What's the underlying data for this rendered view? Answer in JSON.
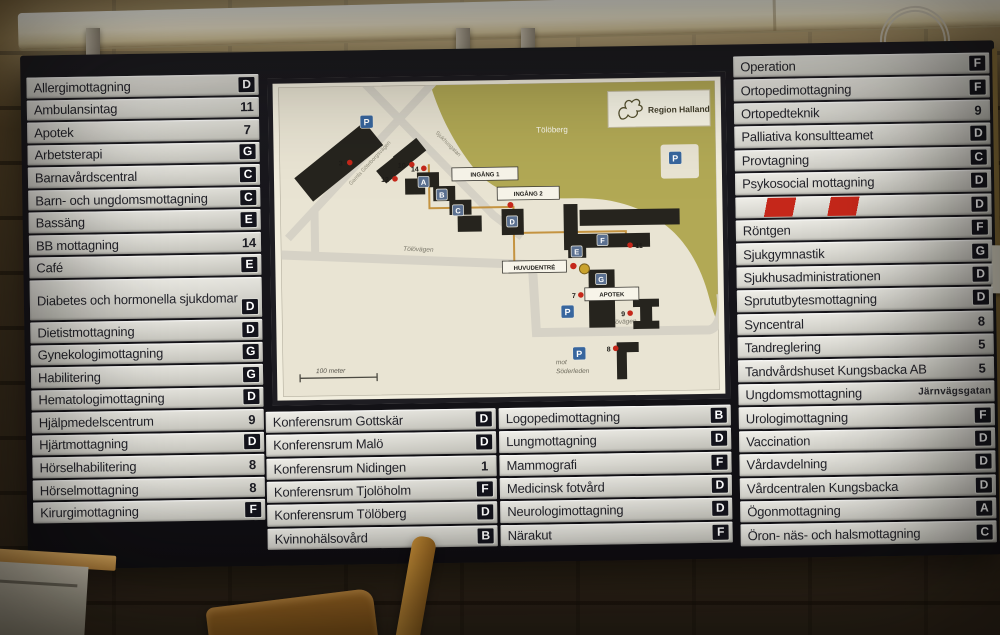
{
  "panels": {
    "left": {
      "rows": [
        {
          "label": "Allergimottagning",
          "value": "D",
          "kind": "letter"
        },
        {
          "label": "Ambulansintag",
          "value": "11",
          "kind": "number"
        },
        {
          "label": "Apotek",
          "value": "7",
          "kind": "number"
        },
        {
          "label": "Arbetsterapi",
          "value": "G",
          "kind": "letter"
        },
        {
          "label": "Barnavårdscentral",
          "value": "C",
          "kind": "letter"
        },
        {
          "label": "Barn- och ungdomsmottagning",
          "value": "C",
          "kind": "letter"
        },
        {
          "label": "Bassäng",
          "value": "E",
          "kind": "letter"
        },
        {
          "label": "BB mottagning",
          "value": "14",
          "kind": "number"
        },
        {
          "label": "Café",
          "value": "E",
          "kind": "letter"
        },
        {
          "label": "Diabetes och hormonella sjukdomar",
          "value": "D",
          "kind": "letter",
          "tall": true
        },
        {
          "label": "Dietistmottagning",
          "value": "D",
          "kind": "letter"
        },
        {
          "label": "Gynekologimottagning",
          "value": "G",
          "kind": "letter"
        },
        {
          "label": "Habilitering",
          "value": "G",
          "kind": "letter"
        },
        {
          "label": "Hematologimottagning",
          "value": "D",
          "kind": "letter"
        },
        {
          "label": "Hjälpmedelscentrum",
          "value": "9",
          "kind": "number"
        },
        {
          "label": "Hjärtmottagning",
          "value": "D",
          "kind": "letter"
        },
        {
          "label": "Hörselhabilitering",
          "value": "8",
          "kind": "number"
        },
        {
          "label": "Hörselmottagning",
          "value": "8",
          "kind": "number"
        },
        {
          "label": "Kirurgimottagning",
          "value": "F",
          "kind": "letter"
        }
      ]
    },
    "conference": {
      "rows": [
        {
          "label": "Konferensrum Gottskär",
          "value": "D",
          "kind": "letter"
        },
        {
          "label": "Konferensrum Malö",
          "value": "D",
          "kind": "letter"
        },
        {
          "label": "Konferensrum Nidingen",
          "value": "1",
          "kind": "number"
        },
        {
          "label": "Konferensrum Tjolöholm",
          "value": "F",
          "kind": "letter"
        },
        {
          "label": "Konferensrum Tölöberg",
          "value": "D",
          "kind": "letter"
        },
        {
          "label": "Kvinnohälsovård",
          "value": "B",
          "kind": "letter"
        }
      ]
    },
    "clinics": {
      "rows": [
        {
          "label": "Logopedimottagning",
          "value": "B",
          "kind": "letter"
        },
        {
          "label": "Lungmottagning",
          "value": "D",
          "kind": "letter"
        },
        {
          "label": "Mammografi",
          "value": "F",
          "kind": "letter"
        },
        {
          "label": "Medicinsk fotvård",
          "value": "D",
          "kind": "letter"
        },
        {
          "label": "Neurologimottagning",
          "value": "D",
          "kind": "letter"
        },
        {
          "label": "Närakut",
          "value": "F",
          "kind": "letter"
        }
      ]
    },
    "right": {
      "rows": [
        {
          "label": "Operation",
          "value": "F",
          "kind": "letter"
        },
        {
          "label": "Ortopedimottagning",
          "value": "F",
          "kind": "letter"
        },
        {
          "label": "Ortopedteknik",
          "value": "9",
          "kind": "number"
        },
        {
          "label": "Palliativa konsultteamet",
          "value": "D",
          "kind": "letter"
        },
        {
          "label": "Provtagning",
          "value": "C",
          "kind": "letter"
        },
        {
          "label": "Psykosocial mottagning",
          "value": "D",
          "kind": "letter"
        },
        {
          "label": "",
          "value": "D",
          "kind": "striped"
        },
        {
          "label": "Röntgen",
          "value": "F",
          "kind": "letter"
        },
        {
          "label": "Sjukgymnastik",
          "value": "G",
          "kind": "letter"
        },
        {
          "label": "Sjukhusadministrationen",
          "value": "D",
          "kind": "letter"
        },
        {
          "label": "Sprututbytesmottagning",
          "value": "D",
          "kind": "letter"
        },
        {
          "label": "Syncentral",
          "value": "8",
          "kind": "number"
        },
        {
          "label": "Tandreglering",
          "value": "5",
          "kind": "number"
        },
        {
          "label": "Tandvårdshuset Kungsbacka AB",
          "value": "5",
          "kind": "number"
        },
        {
          "label": "Ungdomsmottagning",
          "value": "Järnvägsgatan",
          "kind": "text"
        },
        {
          "label": "Urologimottagning",
          "value": "F",
          "kind": "letter"
        },
        {
          "label": "Vaccination",
          "value": "D",
          "kind": "letter"
        },
        {
          "label": "Vårdavdelning",
          "value": "D",
          "kind": "letter"
        },
        {
          "label": "Vårdcentralen Kungsbacka",
          "value": "D",
          "kind": "letter"
        },
        {
          "label": "Ögonmottagning",
          "value": "A",
          "kind": "letter"
        },
        {
          "label": "Öron- näs- och halsmottagning",
          "value": "C",
          "kind": "letter"
        }
      ]
    }
  },
  "map": {
    "logo_text": "Region Halland",
    "hill_label": "Tölöberg",
    "streets": {
      "gamla_goteborgsvagen": "Gamla Göteborgsvägen",
      "sjukhusgatan": "Sjukhusgatan",
      "tolovagen": "Tölövägen",
      "tolovagen_2": "Tölövägen"
    },
    "labels": {
      "ingang1": "INGÅNG 1",
      "ingang2": "INGÅNG 2",
      "huvudentre": "HUVUDENTRÉ",
      "apotek": "APOTEK",
      "mot_line1": "mot",
      "mot_line2": "Söderleden",
      "scale": "100 meter"
    },
    "building_badges": {
      "a": "A",
      "b": "B",
      "c": "C",
      "d": "D",
      "e": "E",
      "f": "F",
      "g": "G"
    },
    "numbers": {
      "n3": "3",
      "n7": "7",
      "n8": "8",
      "n9": "9",
      "n10": "10",
      "n11": "11",
      "n12": "12",
      "n14": "14"
    },
    "parking_label": "P"
  },
  "colors": {
    "badge_bg": "#14141c",
    "map_green": "#b2a955",
    "map_beige": "#e9e4d3",
    "accent_red": "#c5271a",
    "parking_blue": "#38669e"
  }
}
